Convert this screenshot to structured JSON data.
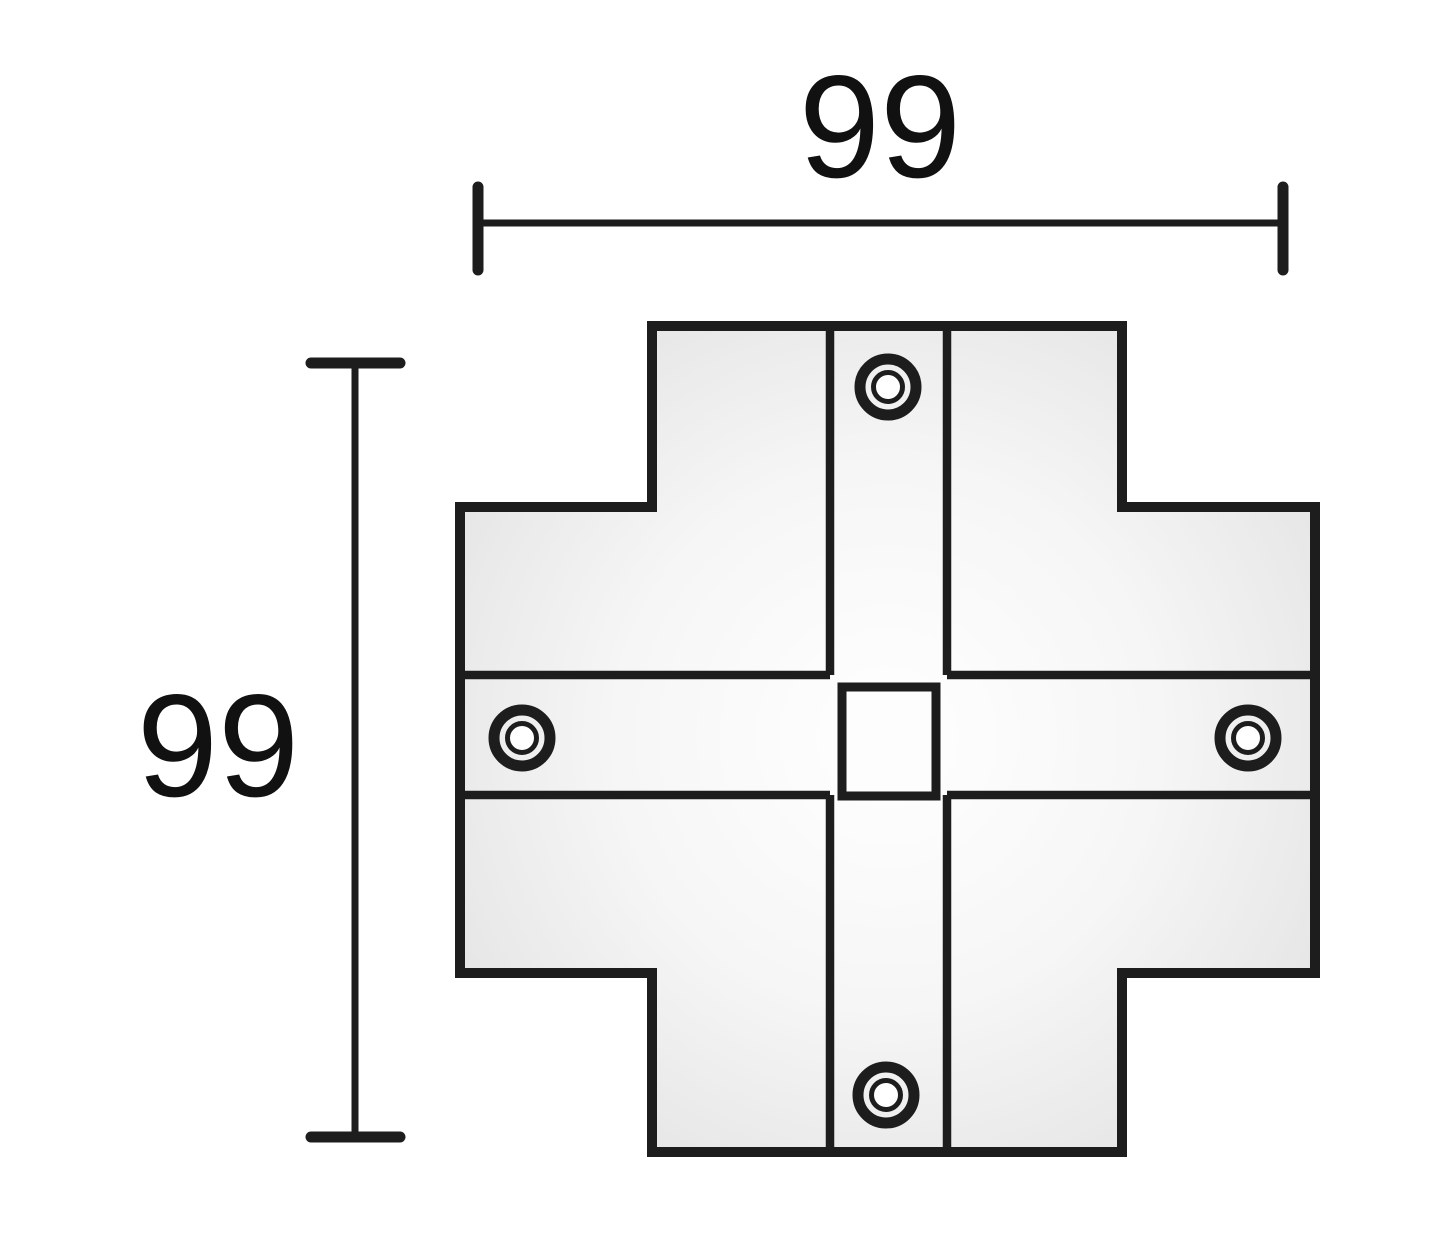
{
  "diagram": {
    "type": "technical-dimension-drawing",
    "width_label": "99",
    "height_label": "99",
    "part": {
      "shape": "cross-connector-plate",
      "screw_positions": [
        "top",
        "left",
        "right",
        "bottom"
      ],
      "screw_count": 4,
      "center_square_cutout": true
    },
    "colors": {
      "line": "#1d1d1d",
      "background": "#ffffff",
      "body_fill_center": "#ffffff",
      "body_fill_edge": "#e2e2e2"
    }
  }
}
